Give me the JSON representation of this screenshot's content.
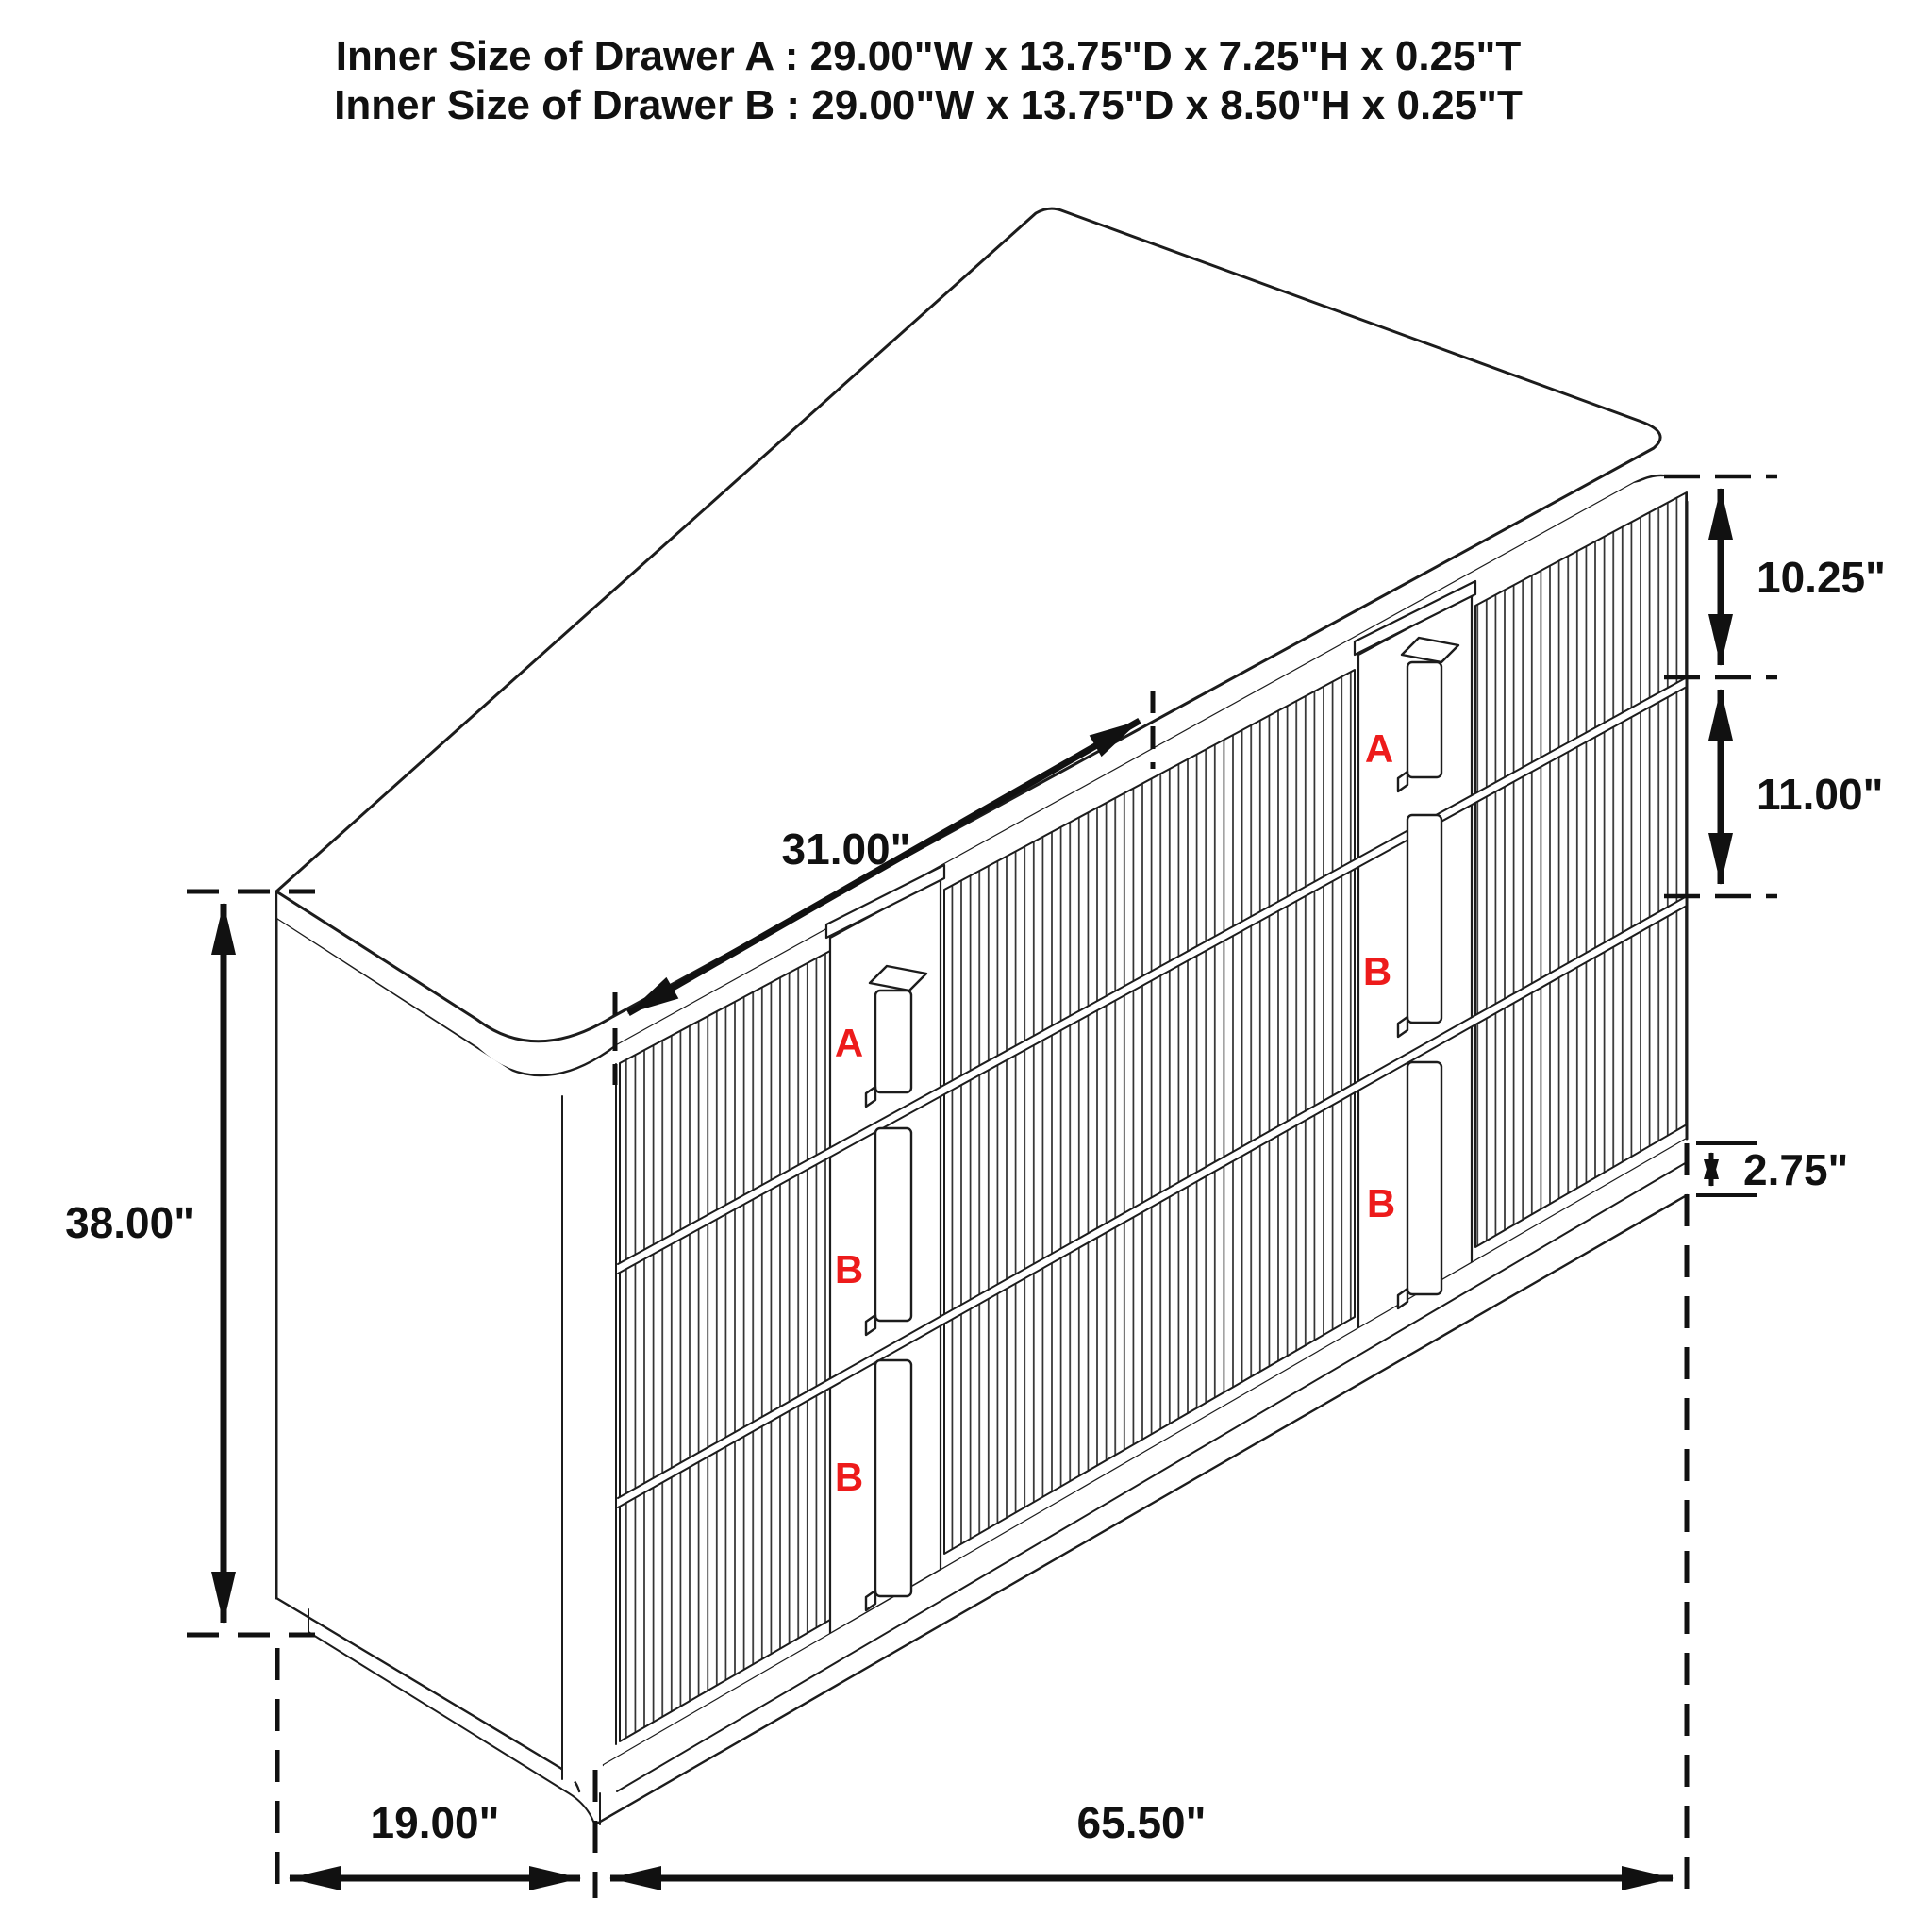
{
  "title": {
    "line1": "Inner Size of Drawer A : 29.00\"W x 13.75\"D x 7.25\"H x 0.25\"T",
    "line2": "Inner Size of Drawer B : 29.00\"W x 13.75\"D x 8.50\"H x 0.25\"T"
  },
  "dimensions": {
    "overall_height": "38.00\"",
    "depth": "19.00\"",
    "overall_width": "65.50\"",
    "center_drawer_width": "31.00\"",
    "top_drawer_height": "10.25\"",
    "middle_drawer_height": "11.00\"",
    "base_height": "2.75\""
  },
  "drawer_labels": {
    "left_column": [
      "A",
      "B",
      "B"
    ],
    "right_column": [
      "A",
      "B",
      "B"
    ]
  },
  "colors": {
    "line": "#1c1c1c",
    "dimension": "#111111",
    "label_red": "#ed1b1b",
    "background": "#ffffff"
  }
}
